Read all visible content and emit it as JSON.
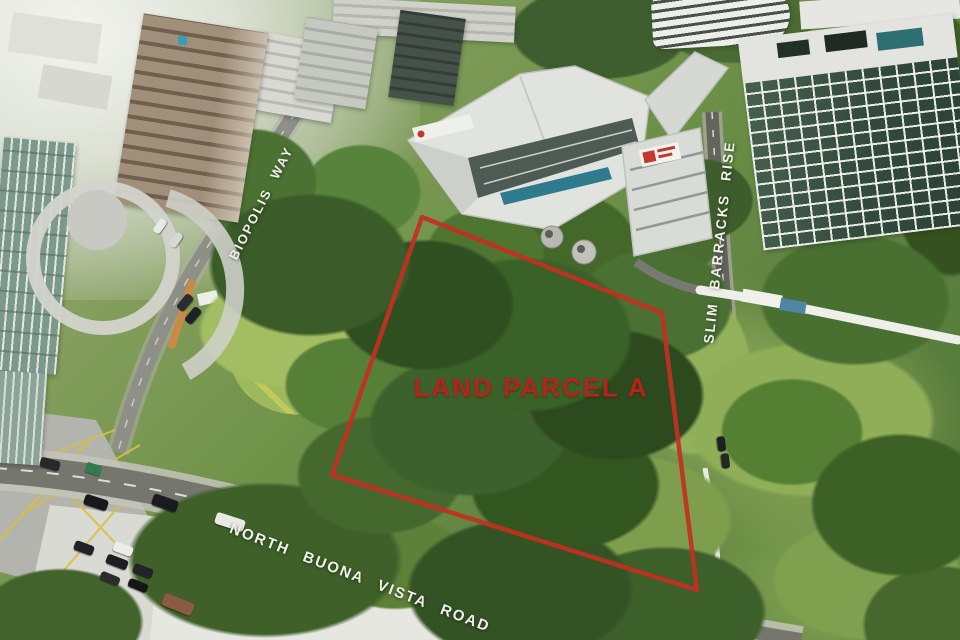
{
  "scene": {
    "type": "annotated aerial photograph",
    "annotation_color": "#c42f22",
    "road_label_color": "#f1f2ec"
  },
  "labels": {
    "parcel": "LAND PARCEL A",
    "biopolis_way": "BIOPOLIS WAY",
    "slim_barracks_rise": "SLIM BARRACKS RISE",
    "north_buona_vista_road": "NORTH BUONA VISTA ROAD"
  },
  "parcel": {
    "outline_points": "422,217 662,313 697,590 332,475"
  }
}
